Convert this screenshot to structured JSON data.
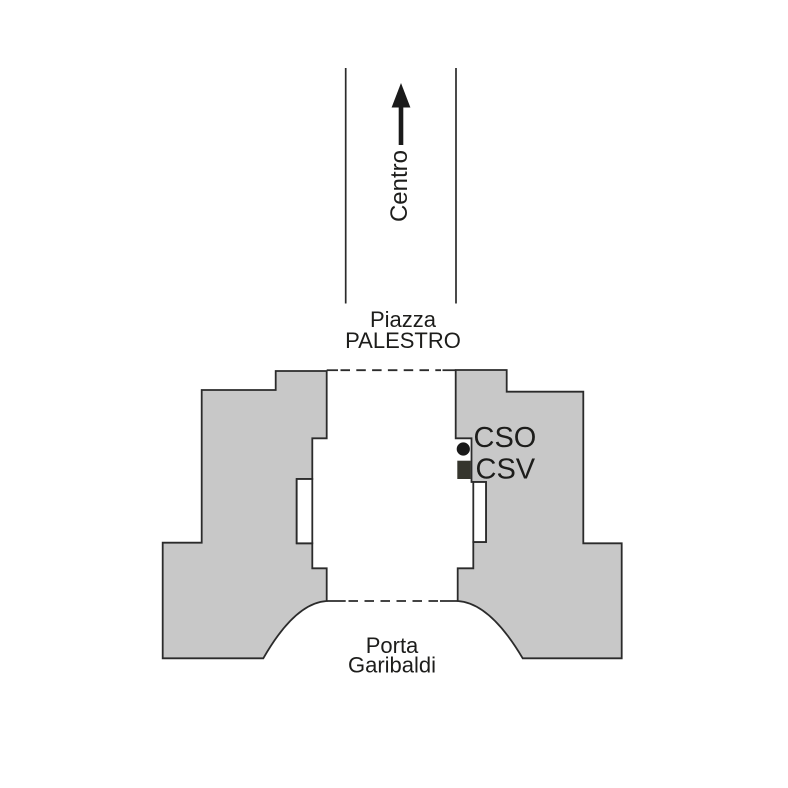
{
  "map": {
    "labels": {
      "direction": "Centro",
      "piazza_line1": "Piazza",
      "piazza_line2": "PALESTRO",
      "gate_line1": "Porta",
      "gate_line2": "Garibaldi"
    },
    "markers": [
      {
        "label": "CSO",
        "shape": "dot"
      },
      {
        "label": "CSV",
        "shape": "square"
      }
    ],
    "colors": {
      "background": "#ffffff",
      "building_fill": "#c8c8c8",
      "outline": "#2b2b2b",
      "text": "#1d1d1b",
      "marker_dot": "#1a1a1a",
      "marker_square": "#35352d"
    }
  }
}
